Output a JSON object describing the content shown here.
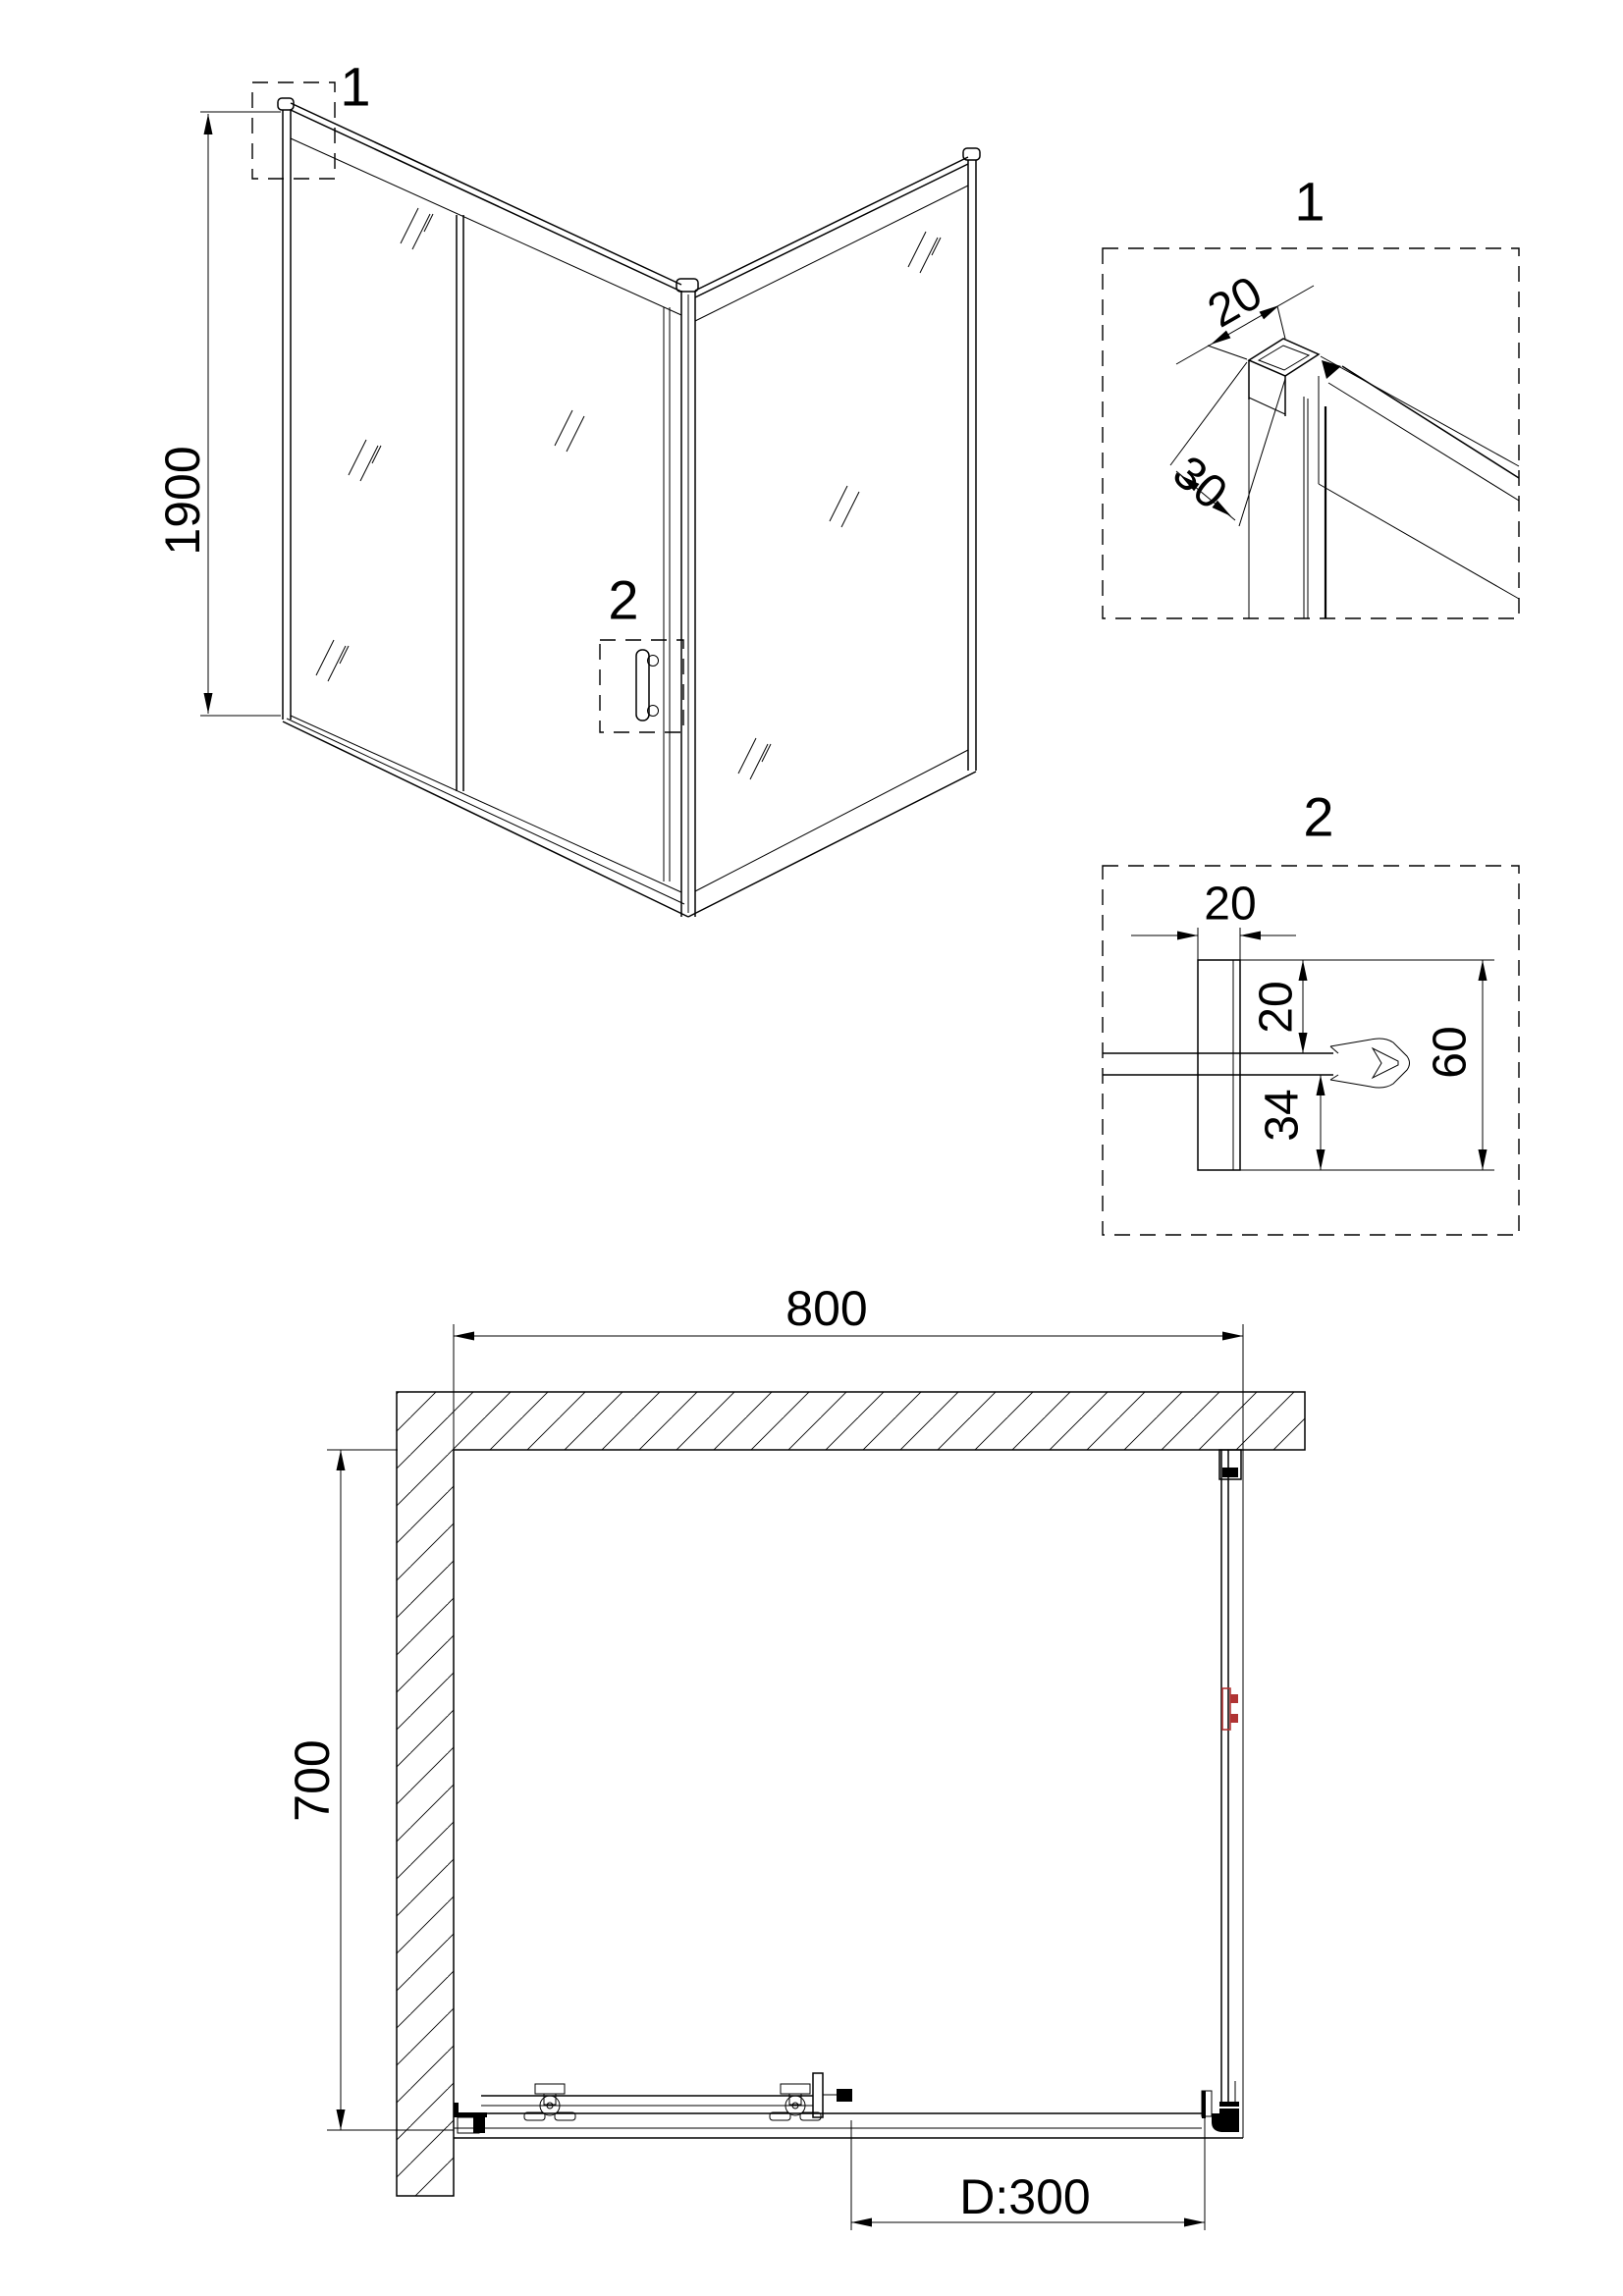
{
  "meta": {
    "type": "technical-drawing",
    "subject": "corner shower enclosure with sliding door",
    "colors": {
      "line": "#000000",
      "accent_red": "#b03333",
      "background": "#ffffff"
    }
  },
  "perspective": {
    "callout_1": "1",
    "callout_2": "2",
    "height_dim": "1900"
  },
  "detail_1": {
    "label": "1",
    "dim_width": "20",
    "dim_depth": "30"
  },
  "detail_2": {
    "label": "2",
    "dim_profile_width": "20",
    "dim_glass_inset": "20",
    "dim_below_glass": "34",
    "dim_total": "60"
  },
  "plan": {
    "dim_width": "800",
    "dim_depth": "700",
    "dim_door": "D:300"
  }
}
